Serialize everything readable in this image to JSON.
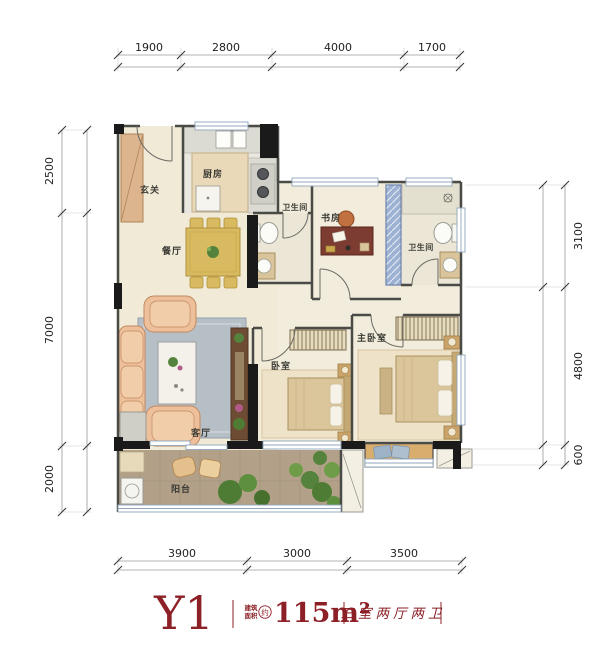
{
  "title": {
    "unit": "Y1",
    "area_label_top": "建筑",
    "area_label_bottom": "面积",
    "area_circle": "约",
    "area_value": "115m²",
    "layout_tags": "三室两厅两卫"
  },
  "rooms": {
    "entry": "玄关",
    "kitchen": "厨房",
    "dining": "餐厅",
    "bath1": "卫生间",
    "study": "书房",
    "bath2": "卫生间",
    "living": "客厅",
    "bedroom": "卧室",
    "master": "主卧室",
    "balcony": "阳台"
  },
  "dimensions": {
    "top": [
      "1900",
      "2800",
      "4000",
      "1700"
    ],
    "bottom": [
      "3900",
      "3000",
      "3500"
    ],
    "left": [
      "2500",
      "7000",
      "2000"
    ],
    "right": [
      "3100",
      "4800",
      "600"
    ]
  },
  "colors": {
    "accent": "#8c2026",
    "wall": "#4a4a46",
    "structure": "#1a1a1a",
    "floor": "#f0ead7",
    "balcony_floor": "#b2a188"
  }
}
